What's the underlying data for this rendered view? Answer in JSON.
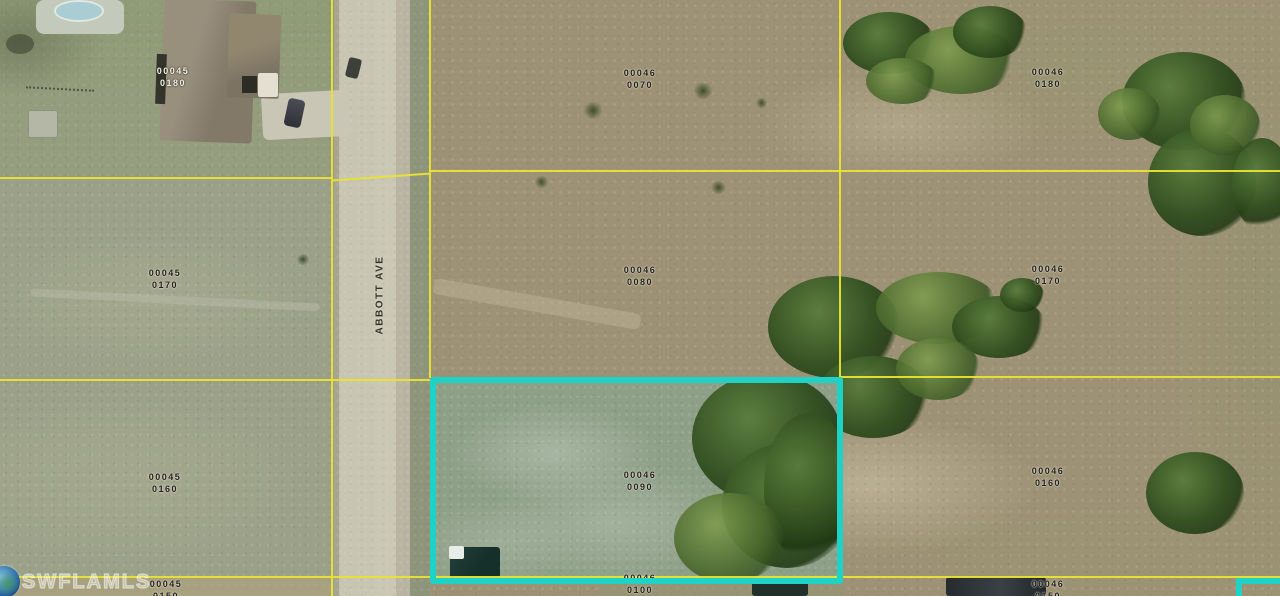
{
  "map": {
    "street": {
      "label": "ABBOTT AVE"
    },
    "watermark": {
      "text": "SWFLAMLS",
      "icon": "globe-icon"
    },
    "highlight": {
      "parcel": "00046 0090",
      "color": "#1ed3c6"
    },
    "parcel_line_color": "#e9e334",
    "parcels": [
      {
        "id": "00045-0180",
        "line1": "00045",
        "line2": "0180"
      },
      {
        "id": "00046-0070",
        "line1": "00046",
        "line2": "0070"
      },
      {
        "id": "00046-0180",
        "line1": "00046",
        "line2": "0180"
      },
      {
        "id": "00045-0170",
        "line1": "00045",
        "line2": "0170"
      },
      {
        "id": "00046-0080",
        "line1": "00046",
        "line2": "0080"
      },
      {
        "id": "00046-0170",
        "line1": "00046",
        "line2": "0170"
      },
      {
        "id": "00045-0160",
        "line1": "00045",
        "line2": "0160"
      },
      {
        "id": "00046-0090",
        "line1": "00046",
        "line2": "0090"
      },
      {
        "id": "00046-0160",
        "line1": "00046",
        "line2": "0160"
      },
      {
        "id": "00045-0150",
        "line1": "00045",
        "line2": "0150"
      },
      {
        "id": "00046-0100",
        "line1": "00046",
        "line2": "0100"
      },
      {
        "id": "00046-0150",
        "line1": "00046",
        "line2": "0150"
      }
    ]
  }
}
